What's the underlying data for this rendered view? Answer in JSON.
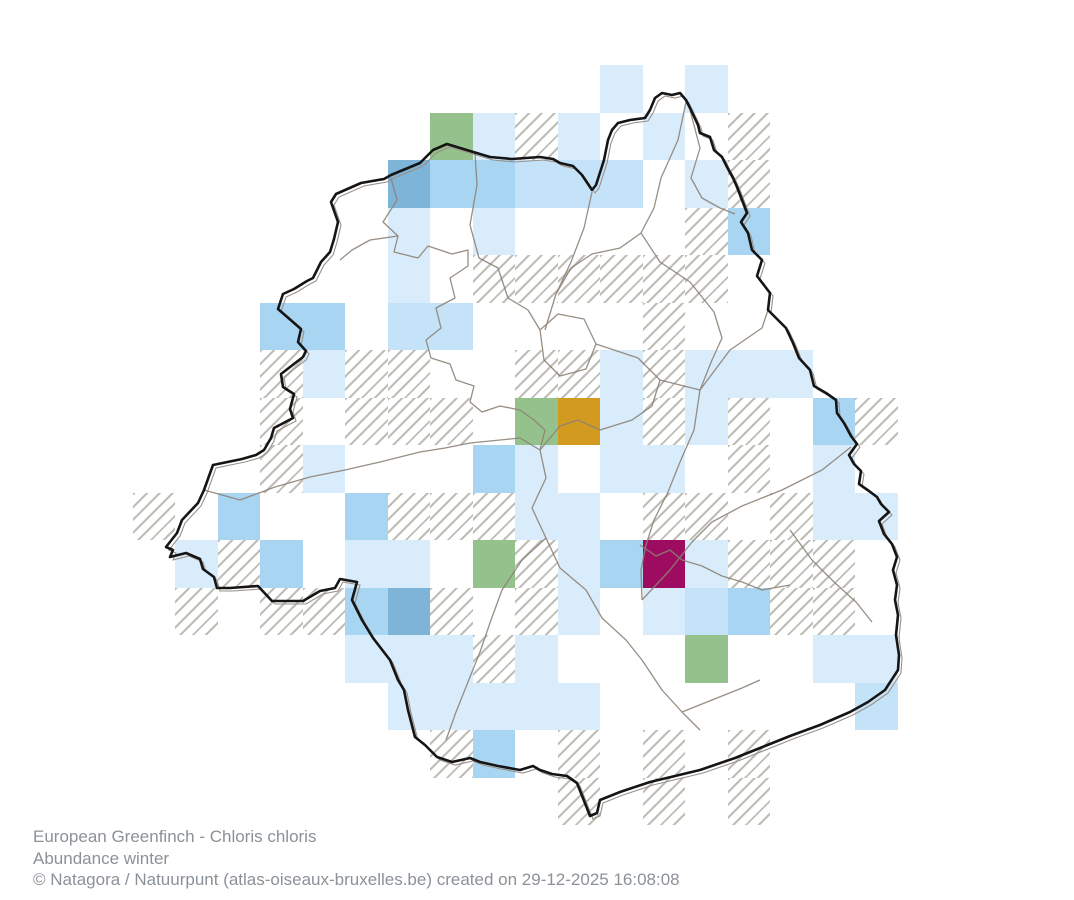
{
  "map": {
    "name": "brussels-abundance-grid-map",
    "grid": {
      "origin_x": 132.5,
      "origin_y": 17.5,
      "cell_w": 42.5,
      "cell_h": 47.5
    },
    "palette": {
      "pale": "#d9ecfb",
      "light": "#c5e3f8",
      "medium": "#a8d5f2",
      "dark": "#7fb4d9",
      "green": "#95c28c",
      "orange": "#d29b20",
      "magenta": "#9d0c60",
      "hatch_line": "#b2b2aa",
      "boundary": "#151515",
      "boundary_companion": "#9a9089",
      "municipal": "#8d8276",
      "footer_text": "#8b9198",
      "background": "#ffffff"
    },
    "cells": [
      {
        "c": 11,
        "r": 1,
        "v": "pale"
      },
      {
        "c": 13,
        "r": 1,
        "v": "pale"
      },
      {
        "c": 7,
        "r": 2,
        "v": "green"
      },
      {
        "c": 8,
        "r": 2,
        "v": "pale"
      },
      {
        "c": 9,
        "r": 2,
        "v": "survey"
      },
      {
        "c": 10,
        "r": 2,
        "v": "pale"
      },
      {
        "c": 12,
        "r": 2,
        "v": "pale"
      },
      {
        "c": 14,
        "r": 2,
        "v": "survey"
      },
      {
        "c": 6,
        "r": 3,
        "v": "dark"
      },
      {
        "c": 7,
        "r": 3,
        "v": "medium"
      },
      {
        "c": 8,
        "r": 3,
        "v": "medium"
      },
      {
        "c": 9,
        "r": 3,
        "v": "light"
      },
      {
        "c": 10,
        "r": 3,
        "v": "light"
      },
      {
        "c": 11,
        "r": 3,
        "v": "light"
      },
      {
        "c": 13,
        "r": 3,
        "v": "pale"
      },
      {
        "c": 14,
        "r": 3,
        "v": "survey"
      },
      {
        "c": 6,
        "r": 4,
        "v": "pale"
      },
      {
        "c": 8,
        "r": 4,
        "v": "pale"
      },
      {
        "c": 13,
        "r": 4,
        "v": "survey"
      },
      {
        "c": 14,
        "r": 4,
        "v": "medium"
      },
      {
        "c": 6,
        "r": 5,
        "v": "pale"
      },
      {
        "c": 8,
        "r": 5,
        "v": "survey"
      },
      {
        "c": 9,
        "r": 5,
        "v": "survey"
      },
      {
        "c": 10,
        "r": 5,
        "v": "survey"
      },
      {
        "c": 11,
        "r": 5,
        "v": "survey"
      },
      {
        "c": 12,
        "r": 5,
        "v": "survey"
      },
      {
        "c": 13,
        "r": 5,
        "v": "survey"
      },
      {
        "c": 3,
        "r": 6,
        "v": "medium"
      },
      {
        "c": 4,
        "r": 6,
        "v": "medium"
      },
      {
        "c": 6,
        "r": 6,
        "v": "light"
      },
      {
        "c": 7,
        "r": 6,
        "v": "light"
      },
      {
        "c": 12,
        "r": 6,
        "v": "survey"
      },
      {
        "c": 3,
        "r": 7,
        "v": "survey"
      },
      {
        "c": 4,
        "r": 7,
        "v": "pale"
      },
      {
        "c": 5,
        "r": 7,
        "v": "survey"
      },
      {
        "c": 6,
        "r": 7,
        "v": "survey"
      },
      {
        "c": 9,
        "r": 7,
        "v": "survey"
      },
      {
        "c": 10,
        "r": 7,
        "v": "survey"
      },
      {
        "c": 11,
        "r": 7,
        "v": "pale"
      },
      {
        "c": 12,
        "r": 7,
        "v": "survey"
      },
      {
        "c": 13,
        "r": 7,
        "v": "pale"
      },
      {
        "c": 14,
        "r": 7,
        "v": "pale"
      },
      {
        "c": 15,
        "r": 7,
        "v": "pale"
      },
      {
        "c": 3,
        "r": 8,
        "v": "survey"
      },
      {
        "c": 5,
        "r": 8,
        "v": "survey"
      },
      {
        "c": 6,
        "r": 8,
        "v": "survey"
      },
      {
        "c": 7,
        "r": 8,
        "v": "survey"
      },
      {
        "c": 9,
        "r": 8,
        "v": "green"
      },
      {
        "c": 10,
        "r": 8,
        "v": "orange"
      },
      {
        "c": 11,
        "r": 8,
        "v": "pale"
      },
      {
        "c": 12,
        "r": 8,
        "v": "survey"
      },
      {
        "c": 13,
        "r": 8,
        "v": "pale"
      },
      {
        "c": 14,
        "r": 8,
        "v": "survey"
      },
      {
        "c": 16,
        "r": 8,
        "v": "medium"
      },
      {
        "c": 17,
        "r": 8,
        "v": "survey"
      },
      {
        "c": 3,
        "r": 9,
        "v": "survey"
      },
      {
        "c": 4,
        "r": 9,
        "v": "pale"
      },
      {
        "c": 8,
        "r": 9,
        "v": "medium"
      },
      {
        "c": 9,
        "r": 9,
        "v": "pale"
      },
      {
        "c": 11,
        "r": 9,
        "v": "pale"
      },
      {
        "c": 12,
        "r": 9,
        "v": "pale"
      },
      {
        "c": 14,
        "r": 9,
        "v": "survey"
      },
      {
        "c": 16,
        "r": 9,
        "v": "pale"
      },
      {
        "c": 0,
        "r": 10,
        "v": "survey"
      },
      {
        "c": 2,
        "r": 10,
        "v": "medium"
      },
      {
        "c": 5,
        "r": 10,
        "v": "medium"
      },
      {
        "c": 6,
        "r": 10,
        "v": "survey"
      },
      {
        "c": 7,
        "r": 10,
        "v": "survey"
      },
      {
        "c": 8,
        "r": 10,
        "v": "survey"
      },
      {
        "c": 9,
        "r": 10,
        "v": "pale"
      },
      {
        "c": 10,
        "r": 10,
        "v": "pale"
      },
      {
        "c": 12,
        "r": 10,
        "v": "survey"
      },
      {
        "c": 13,
        "r": 10,
        "v": "survey"
      },
      {
        "c": 15,
        "r": 10,
        "v": "survey"
      },
      {
        "c": 16,
        "r": 10,
        "v": "pale"
      },
      {
        "c": 17,
        "r": 10,
        "v": "pale"
      },
      {
        "c": 1,
        "r": 11,
        "v": "pale"
      },
      {
        "c": 2,
        "r": 11,
        "v": "survey"
      },
      {
        "c": 3,
        "r": 11,
        "v": "medium"
      },
      {
        "c": 5,
        "r": 11,
        "v": "pale"
      },
      {
        "c": 6,
        "r": 11,
        "v": "pale"
      },
      {
        "c": 8,
        "r": 11,
        "v": "green"
      },
      {
        "c": 9,
        "r": 11,
        "v": "survey"
      },
      {
        "c": 10,
        "r": 11,
        "v": "pale"
      },
      {
        "c": 11,
        "r": 11,
        "v": "medium"
      },
      {
        "c": 12,
        "r": 11,
        "v": "magenta"
      },
      {
        "c": 13,
        "r": 11,
        "v": "pale"
      },
      {
        "c": 14,
        "r": 11,
        "v": "survey"
      },
      {
        "c": 15,
        "r": 11,
        "v": "survey"
      },
      {
        "c": 16,
        "r": 11,
        "v": "survey"
      },
      {
        "c": 1,
        "r": 12,
        "v": "survey"
      },
      {
        "c": 3,
        "r": 12,
        "v": "survey"
      },
      {
        "c": 4,
        "r": 12,
        "v": "survey"
      },
      {
        "c": 5,
        "r": 12,
        "v": "medium"
      },
      {
        "c": 6,
        "r": 12,
        "v": "dark"
      },
      {
        "c": 7,
        "r": 12,
        "v": "survey"
      },
      {
        "c": 9,
        "r": 12,
        "v": "survey"
      },
      {
        "c": 10,
        "r": 12,
        "v": "pale"
      },
      {
        "c": 12,
        "r": 12,
        "v": "pale"
      },
      {
        "c": 13,
        "r": 12,
        "v": "light"
      },
      {
        "c": 14,
        "r": 12,
        "v": "medium"
      },
      {
        "c": 15,
        "r": 12,
        "v": "survey"
      },
      {
        "c": 16,
        "r": 12,
        "v": "survey"
      },
      {
        "c": 5,
        "r": 13,
        "v": "pale"
      },
      {
        "c": 6,
        "r": 13,
        "v": "pale"
      },
      {
        "c": 7,
        "r": 13,
        "v": "pale"
      },
      {
        "c": 8,
        "r": 13,
        "v": "survey"
      },
      {
        "c": 9,
        "r": 13,
        "v": "pale"
      },
      {
        "c": 13,
        "r": 13,
        "v": "green"
      },
      {
        "c": 16,
        "r": 13,
        "v": "pale"
      },
      {
        "c": 17,
        "r": 13,
        "v": "pale"
      },
      {
        "c": 6,
        "r": 14,
        "v": "pale"
      },
      {
        "c": 7,
        "r": 14,
        "v": "pale"
      },
      {
        "c": 8,
        "r": 14,
        "v": "pale"
      },
      {
        "c": 9,
        "r": 14,
        "v": "pale"
      },
      {
        "c": 10,
        "r": 14,
        "v": "pale"
      },
      {
        "c": 17,
        "r": 14,
        "v": "light"
      },
      {
        "c": 7,
        "r": 15,
        "v": "survey"
      },
      {
        "c": 8,
        "r": 15,
        "v": "medium"
      },
      {
        "c": 10,
        "r": 15,
        "v": "survey"
      },
      {
        "c": 12,
        "r": 15,
        "v": "survey"
      },
      {
        "c": 14,
        "r": 15,
        "v": "survey"
      },
      {
        "c": 10,
        "r": 16,
        "v": "survey"
      },
      {
        "c": 12,
        "r": 16,
        "v": "survey"
      },
      {
        "c": 14,
        "r": 16,
        "v": "survey"
      }
    ]
  },
  "footer": {
    "line1": "European Greenfinch - Chloris chloris",
    "line2": "Abundance winter",
    "line3": "© Natagora / Natuurpunt (atlas-oiseaux-bruxelles.be) created on 29-12-2025 16:08:08"
  }
}
